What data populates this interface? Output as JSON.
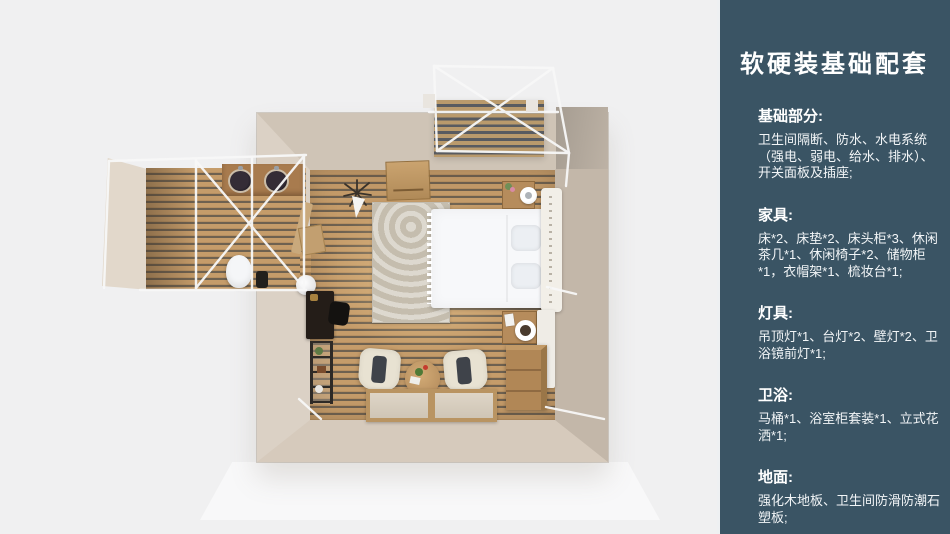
{
  "slide": {
    "title": "软硬装基础配套",
    "sections": [
      {
        "heading": "基础部分:",
        "body": "卫生间隔断、防水、水电系统（强电、弱电、给水、排水）、开关面板及插座;"
      },
      {
        "heading": "家具:",
        "body": "床*2、床垫*2、床头柜*3、休闲茶几*1、休闲椅子*2、储物柜*1，衣帽架*1、梳妆台*1;"
      },
      {
        "heading": "灯具:",
        "body": "吊顶灯*1、台灯*2、壁灯*2、卫浴镜前灯*1;"
      },
      {
        "heading": "卫浴:",
        "body": "马桶*1、浴室柜套装*1、立式花洒*1;"
      },
      {
        "heading": "地面:",
        "body": "强化木地板、卫生间防滑防潮石塑板;"
      }
    ]
  },
  "colors": {
    "sidebar_bg": "#3a5464",
    "sidebar_text": "#ffffff",
    "canvas_bg": "#f0f0f1",
    "wall_beige": "#d2c6b8",
    "floor_wood": "#c59c6a",
    "floor_gap": "#6e6150",
    "frame_white": "#f8f8f8"
  }
}
